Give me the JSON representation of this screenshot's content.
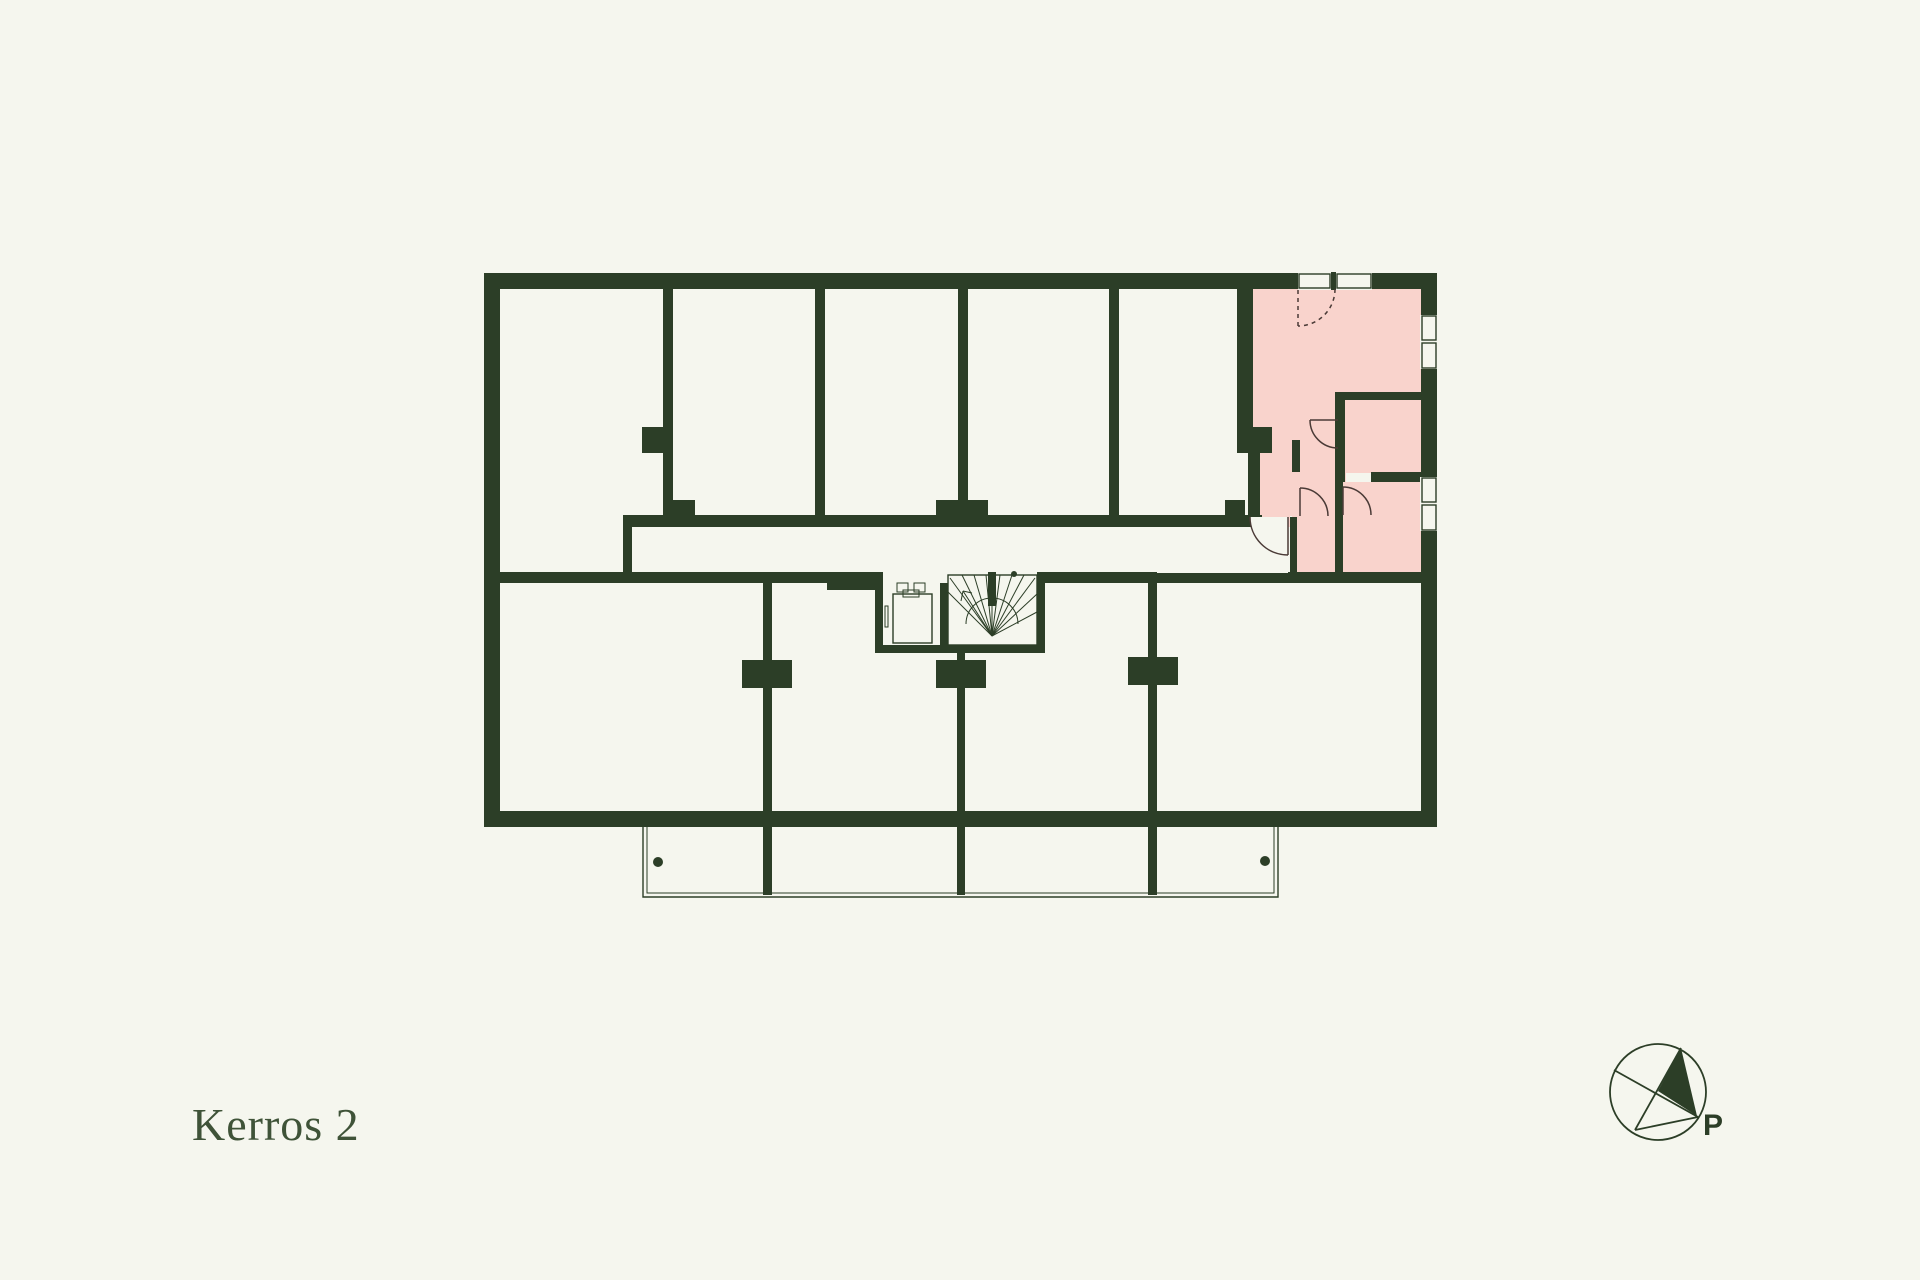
{
  "title": "Kerros 2",
  "compass": {
    "label": "P"
  },
  "colors": {
    "background": "#f5f6ee",
    "wall": "#2c3e27",
    "highlight": "#f9d3cc",
    "title_text": "#3f5338"
  },
  "plan": {
    "highlighted_unit": "top-right apartment",
    "features": [
      "stairwell",
      "elevator",
      "balconies",
      "corridor"
    ]
  }
}
